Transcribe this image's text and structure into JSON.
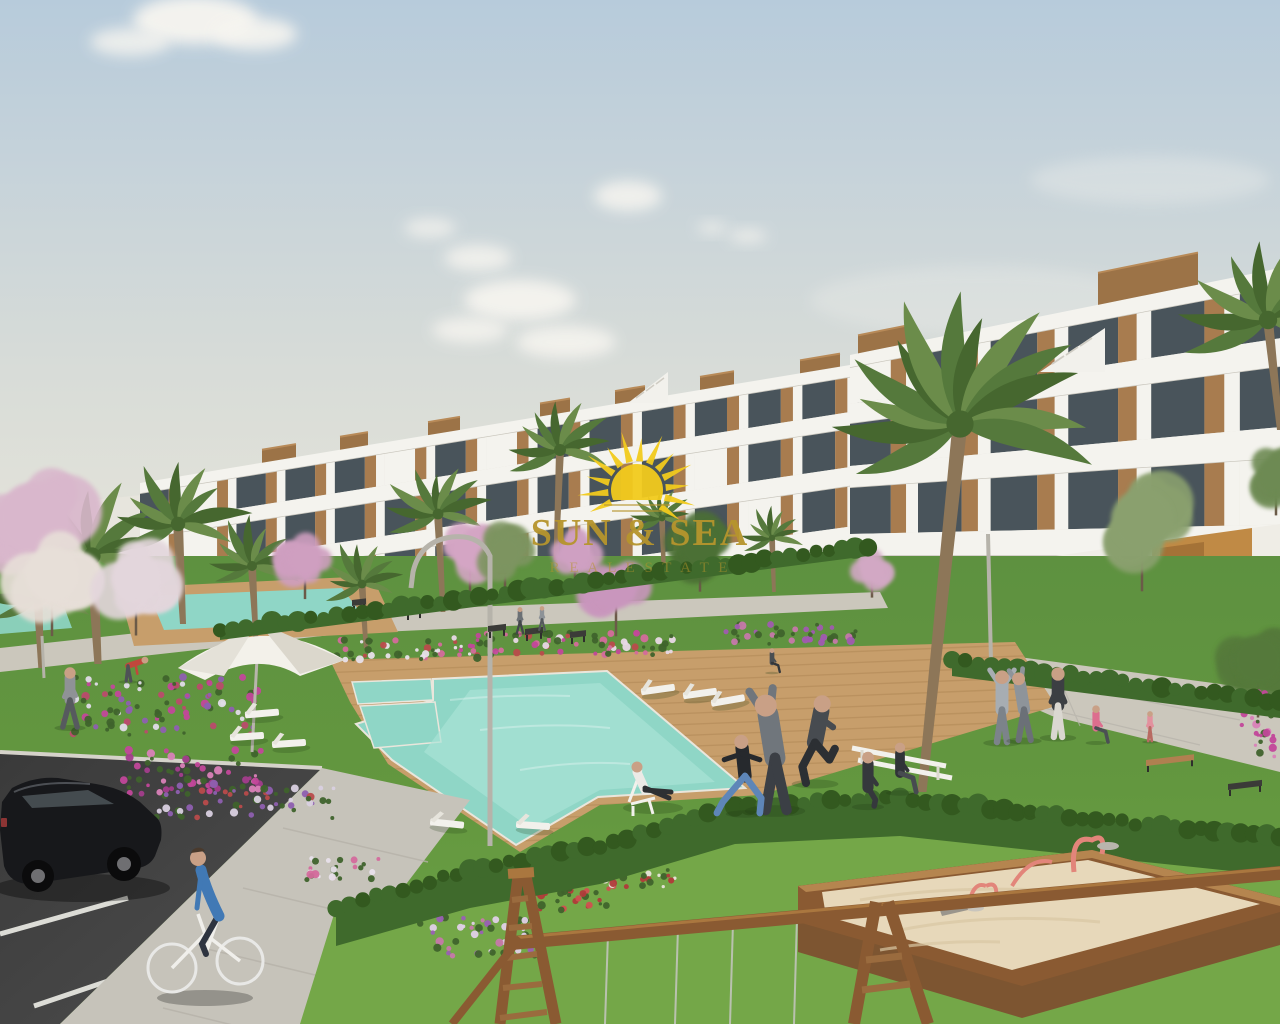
{
  "scene": {
    "type": "architectural-render",
    "description": "New-build white terraced apartment complex with communal pools, gardens, palm trees, playground, parking and residents outdoors",
    "watermark": {
      "brand": "SUN & SEA",
      "tagline": "R E A L   E S T A T E",
      "logo": "sun-icon"
    }
  },
  "palette": {
    "sky_top": "#b7cbdb",
    "sky_mid": "#d8dcd8",
    "sky_low": "#e9e6da",
    "cloud": "#f7f5f0",
    "bldg_white": "#f4f3ee",
    "bldg_shade": "#e1ded5",
    "bldg_edge": "#c9c6bd",
    "glass": "#49545b",
    "glass_light": "#8d9aa0",
    "wood": "#a87c4f",
    "wood_dark": "#8a6340",
    "roofbox": "#9c7347",
    "ochre": "#c08a45",
    "ochre_dark": "#9c6c33",
    "lawn": "#63973f",
    "lawn_bright": "#74a748",
    "lawn_dark": "#517f34",
    "hedge": "#3f6a2c",
    "hedge_dark": "#33591f",
    "palm1": "#55793c",
    "palm2": "#46672f",
    "palm3": "#6b8c4a",
    "trunk": "#8d7658",
    "path": "#cbc7bc",
    "path_line": "#b5b2a9",
    "deck": "#c79e6b",
    "deck_line": "#a9804e",
    "pool": "#8fd6c6",
    "pool_light": "#abe4d7",
    "asphalt": "#474747",
    "asphalt_dark": "#3a3a3a",
    "white_line": "#dcdcd6",
    "sidewalk": "#c6c3ba",
    "sand": "#e7d8ba",
    "frame_wood": "#8a5a32",
    "frame_wood_light": "#aa773f",
    "play_pink": "#e2857a",
    "car_body": "#17181b",
    "car_window": "#474e52",
    "metal": "#b6b3aa",
    "white_furniture": "#f2f1ec",
    "gold": "#b6952d",
    "sun_yellow": "#f2cb1d",
    "skin": "#c9a086",
    "shadow": "#1e3a14"
  },
  "clouds": [
    {
      "x": 195,
      "y": 20,
      "rx": 62,
      "ry": 24,
      "o": 0.95
    },
    {
      "x": 255,
      "y": 34,
      "rx": 42,
      "ry": 16,
      "o": 0.9
    },
    {
      "x": 130,
      "y": 42,
      "rx": 40,
      "ry": 14,
      "o": 0.8
    },
    {
      "x": 430,
      "y": 228,
      "rx": 26,
      "ry": 10,
      "o": 0.7
    },
    {
      "x": 478,
      "y": 258,
      "rx": 34,
      "ry": 13,
      "o": 0.8
    },
    {
      "x": 520,
      "y": 300,
      "rx": 56,
      "ry": 20,
      "o": 0.9
    },
    {
      "x": 566,
      "y": 342,
      "rx": 50,
      "ry": 16,
      "o": 0.85
    },
    {
      "x": 470,
      "y": 330,
      "rx": 38,
      "ry": 13,
      "o": 0.8
    },
    {
      "x": 628,
      "y": 196,
      "rx": 34,
      "ry": 15,
      "o": 0.85
    },
    {
      "x": 712,
      "y": 228,
      "rx": 15,
      "ry": 6,
      "o": 0.7
    },
    {
      "x": 748,
      "y": 236,
      "rx": 19,
      "ry": 7,
      "o": 0.7
    },
    {
      "x": 1150,
      "y": 180,
      "rx": 120,
      "ry": 24,
      "o": 0.3
    },
    {
      "x": 980,
      "y": 300,
      "rx": 170,
      "ry": 34,
      "o": 0.25
    }
  ],
  "facade_left": {
    "x1": 140,
    "x2": 868,
    "y_left": [
      483,
      494,
      524,
      539,
      572,
      589,
      624,
      640
    ],
    "y_right_top": 362,
    "k": 1.15,
    "unit": 12
  },
  "facade_right": {
    "x1": 850,
    "x2": 1280,
    "y_left": [
      355,
      368,
      404,
      424,
      466,
      488,
      534,
      556,
      625
    ],
    "y_right_top": 268,
    "k": 1.433,
    "unit": 17
  },
  "roof_boxes_left": [
    {
      "x": 262,
      "w": 34
    },
    {
      "x": 340,
      "w": 28
    },
    {
      "x": 428,
      "w": 32
    },
    {
      "x": 540,
      "w": 30
    },
    {
      "x": 615,
      "w": 30
    },
    {
      "x": 700,
      "w": 34
    },
    {
      "x": 800,
      "w": 40
    }
  ],
  "roof_boxes_right": [
    {
      "x": 858,
      "w": 56,
      "h": 18
    },
    {
      "x": 1098,
      "w": 100,
      "h": 32
    }
  ],
  "palms": [
    {
      "x": 92,
      "y": 556,
      "r": 86,
      "tx": 98,
      "ty": 664,
      "tw": 12
    },
    {
      "x": 178,
      "y": 524,
      "r": 72,
      "tx": 183,
      "ty": 624,
      "tw": 10
    },
    {
      "x": 38,
      "y": 598,
      "r": 60,
      "tx": 41,
      "ty": 668,
      "tw": 9
    },
    {
      "x": 252,
      "y": 566,
      "r": 50,
      "tx": 256,
      "ty": 640,
      "tw": 8
    },
    {
      "x": 362,
      "y": 584,
      "r": 44,
      "tx": 366,
      "ty": 648,
      "tw": 7
    },
    {
      "x": 438,
      "y": 514,
      "r": 54,
      "tx": 443,
      "ty": 612,
      "tw": 8
    },
    {
      "x": 560,
      "y": 450,
      "r": 60,
      "tx": 556,
      "ty": 560,
      "tw": 8
    },
    {
      "x": 662,
      "y": 518,
      "r": 34,
      "tx": 664,
      "ty": 578,
      "tw": 6
    },
    {
      "x": 772,
      "y": 538,
      "r": 32,
      "tx": 774,
      "ty": 592,
      "tw": 6
    },
    {
      "x": 960,
      "y": 424,
      "r": 136,
      "tx": 922,
      "ty": 792,
      "tw": 15
    },
    {
      "x": 1268,
      "y": 320,
      "r": 92,
      "tx": 1280,
      "ty": 430,
      "tw": 10
    }
  ],
  "trees": [
    {
      "x": 34,
      "y": 518,
      "r": 72,
      "c": "#d9b7cc"
    },
    {
      "x": 52,
      "y": 574,
      "r": 54,
      "c": "#e7dfd8"
    },
    {
      "x": 136,
      "y": 578,
      "r": 50,
      "c": "#e3d6dc"
    },
    {
      "x": 305,
      "y": 560,
      "r": 34,
      "c": "#cf9fc0"
    },
    {
      "x": 470,
      "y": 552,
      "r": 36,
      "c": "#d4a5c4"
    },
    {
      "x": 575,
      "y": 552,
      "r": 30,
      "c": "#cfa0c2"
    },
    {
      "x": 616,
      "y": 588,
      "r": 42,
      "c": "#c996bd"
    },
    {
      "x": 700,
      "y": 548,
      "r": 38,
      "c": "#4c7034"
    },
    {
      "x": 505,
      "y": 552,
      "r": 34,
      "c": "#7d9460"
    },
    {
      "x": 872,
      "y": 570,
      "r": 24,
      "c": "#d2a8c4"
    },
    {
      "x": 1142,
      "y": 520,
      "r": 62,
      "c": "#8aa06e"
    },
    {
      "x": 1258,
      "y": 660,
      "r": 50,
      "c": "#55793b"
    },
    {
      "x": 1276,
      "y": 474,
      "r": 36,
      "c": "#6d8a52"
    }
  ],
  "flower_beds": [
    {
      "x": 160,
      "y": 706,
      "w": 200,
      "h": 58,
      "n": 95,
      "colors": [
        "#c2479a",
        "#8e5fb0",
        "#e0dce8",
        "#b94b6b"
      ]
    },
    {
      "x": 195,
      "y": 772,
      "w": 150,
      "h": 44,
      "n": 60,
      "colors": [
        "#c2479a",
        "#a33d8c",
        "#d981b8"
      ]
    },
    {
      "x": 245,
      "y": 800,
      "w": 180,
      "h": 38,
      "n": 55,
      "colors": [
        "#b94b4b",
        "#8e5fb0",
        "#d9d0e0"
      ]
    },
    {
      "x": 405,
      "y": 650,
      "w": 150,
      "h": 20,
      "n": 45,
      "colors": [
        "#d46a9c",
        "#b94b4b",
        "#e8e0ea"
      ]
    },
    {
      "x": 560,
      "y": 644,
      "w": 230,
      "h": 22,
      "n": 70,
      "colors": [
        "#d46a9c",
        "#c2479a",
        "#e8d8e6",
        "#b94b4b"
      ]
    },
    {
      "x": 790,
      "y": 634,
      "w": 140,
      "h": 20,
      "n": 40,
      "colors": [
        "#c678aa",
        "#a05ab0"
      ]
    },
    {
      "x": 480,
      "y": 936,
      "w": 120,
      "h": 40,
      "n": 45,
      "colors": [
        "#9a5fb5",
        "#c678aa",
        "#e0d0e8"
      ]
    },
    {
      "x": 570,
      "y": 898,
      "w": 90,
      "h": 24,
      "n": 30,
      "colors": [
        "#b03a3a",
        "#d05050"
      ]
    },
    {
      "x": 640,
      "y": 878,
      "w": 70,
      "h": 18,
      "n": 22,
      "colors": [
        "#b03a3a",
        "#e8e4da"
      ]
    },
    {
      "x": 1258,
      "y": 726,
      "w": 44,
      "h": 70,
      "n": 32,
      "colors": [
        "#c2479a",
        "#d981b8"
      ]
    },
    {
      "x": 340,
      "y": 870,
      "w": 80,
      "h": 24,
      "n": 25,
      "colors": [
        "#d46a9c",
        "#e8e0ea"
      ]
    }
  ],
  "hedge_front": {
    "points": [
      [
        336,
        908
      ],
      [
        470,
        870
      ],
      [
        600,
        846
      ],
      [
        735,
        806
      ],
      [
        900,
        798
      ],
      [
        1030,
        812
      ],
      [
        1280,
        838
      ]
    ],
    "width": 38
  },
  "hedge_right": {
    "points": [
      [
        952,
        660
      ],
      [
        1280,
        702
      ]
    ],
    "width": 16
  },
  "hedge_base_left": {
    "points": [
      [
        220,
        630
      ],
      [
        868,
        546
      ]
    ],
    "width": 10
  },
  "loungers": [
    {
      "x": 658,
      "y": 690,
      "rot": -8
    },
    {
      "x": 700,
      "y": 694,
      "rot": -8
    },
    {
      "x": 728,
      "y": 701,
      "rot": -10
    },
    {
      "x": 447,
      "y": 824,
      "rot": 6
    },
    {
      "x": 533,
      "y": 826,
      "rot": 4
    },
    {
      "x": 247,
      "y": 737,
      "rot": -4
    },
    {
      "x": 289,
      "y": 744,
      "rot": -4
    },
    {
      "x": 262,
      "y": 714,
      "rot": -5
    }
  ],
  "benches": [
    {
      "x": 352,
      "y": 600,
      "w": 14,
      "type": "dark"
    },
    {
      "x": 406,
      "y": 608,
      "w": 16,
      "type": "dark"
    },
    {
      "x": 488,
      "y": 626,
      "w": 18,
      "type": "dark"
    },
    {
      "x": 525,
      "y": 629,
      "w": 18,
      "type": "dark"
    },
    {
      "x": 570,
      "y": 632,
      "w": 16,
      "type": "dark"
    },
    {
      "x": 1146,
      "y": 760,
      "w": 48,
      "type": "wood"
    },
    {
      "x": 1228,
      "y": 784,
      "w": 34,
      "type": "dark"
    }
  ],
  "people": [
    {
      "x": 70,
      "y": 727,
      "h": 60,
      "pose": "walk",
      "top": "#8f9296",
      "bottom": "#565a5e"
    },
    {
      "x": 128,
      "y": 681,
      "h": 36,
      "pose": "bend",
      "top": "#c2473c",
      "bottom": "#4e5256"
    },
    {
      "x": 520,
      "y": 633,
      "h": 26,
      "pose": "walk",
      "top": "#6b7075",
      "bottom": "#43474b"
    },
    {
      "x": 542,
      "y": 630,
      "h": 24,
      "pose": "walk",
      "top": "#8d9297",
      "bottom": "#54585c"
    },
    {
      "x": 772,
      "y": 672,
      "h": 26,
      "pose": "sit",
      "top": "#4a4e52",
      "bottom": "#33363a"
    },
    {
      "x": 775,
      "y": 810,
      "h": 116,
      "pose": "stretch",
      "top": "#70767c",
      "bottom": "#3b3f45"
    },
    {
      "x": 815,
      "y": 783,
      "h": 90,
      "pose": "run",
      "top": "#474b50",
      "bottom": "#2c2f33"
    },
    {
      "x": 745,
      "y": 813,
      "h": 74,
      "pose": "lunge",
      "top": "#26292d",
      "bottom": "#5e86b8"
    },
    {
      "x": 868,
      "y": 806,
      "h": 62,
      "pose": "kneel",
      "top": "#35383c",
      "bottom": "#35383c"
    },
    {
      "x": 900,
      "y": 792,
      "h": 54,
      "pose": "sit",
      "top": "#303338",
      "bottom": "#474b50"
    },
    {
      "x": 1002,
      "y": 742,
      "h": 72,
      "pose": "armsup",
      "top": "#a7adb2",
      "bottom": "#7c838a"
    },
    {
      "x": 1024,
      "y": 740,
      "h": 68,
      "pose": "stretch",
      "top": "#8e949a",
      "bottom": "#6b7077"
    },
    {
      "x": 1058,
      "y": 737,
      "h": 70,
      "pose": "stand",
      "top": "#3c3f43",
      "bottom": "#dad7d0"
    },
    {
      "x": 1096,
      "y": 742,
      "h": 40,
      "pose": "sit",
      "top": "#dd6e8e",
      "bottom": "#4b4f54"
    },
    {
      "x": 1150,
      "y": 741,
      "h": 30,
      "pose": "stand",
      "top": "#e2919e",
      "bottom": "#b86a62"
    }
  ],
  "chains": [
    608,
    678,
    733,
    797
  ],
  "sun": {
    "cx": 637,
    "cy": 490,
    "disc_r": 26,
    "ray_inner": 29,
    "ray_tips": [
      52,
      60
    ],
    "angles": [
      -205,
      -185,
      -165,
      -145,
      -125,
      -105,
      -85,
      -65,
      -45,
      -25,
      -5,
      15,
      35
    ]
  }
}
